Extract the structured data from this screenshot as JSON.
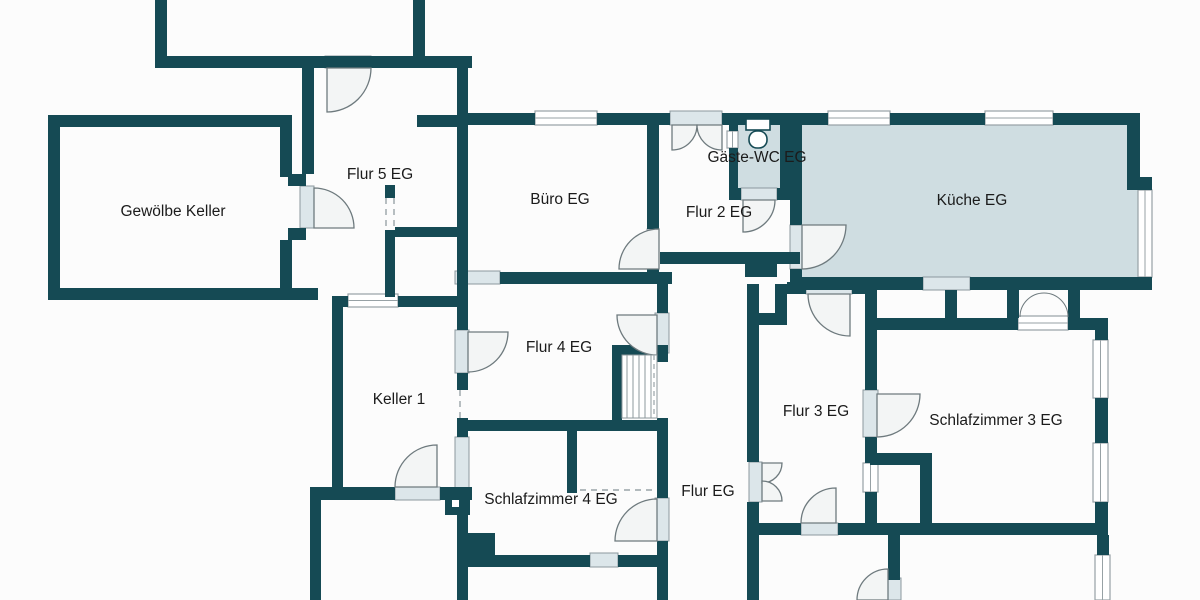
{
  "title": "Grundriss Erdgeschoss / Keller",
  "colors": {
    "background": "#fcfcfc",
    "wall": "#154a54",
    "room_fill": "#cfdde1",
    "door_sill": "#dce6ea",
    "sill_border": "#8b989e",
    "door_arc": "#6e7a7e",
    "door_leaf_fill": "#f3f5f5",
    "window_border": "#97a1a5",
    "stair_line": "#8e989c",
    "dash": "#9aa4a8",
    "text": "#1b1b1b"
  },
  "rooms": [
    {
      "key": "gewoelbe-keller",
      "label": "Gewölbe Keller",
      "x": 173,
      "y": 216
    },
    {
      "key": "flur-5-eg",
      "label": "Flur 5 EG",
      "x": 380,
      "y": 179
    },
    {
      "key": "buero-eg",
      "label": "Büro EG",
      "x": 560,
      "y": 204
    },
    {
      "key": "gaeste-wc-eg",
      "label": "Gäste-WC EG",
      "x": 757,
      "y": 162
    },
    {
      "key": "flur-2-eg",
      "label": "Flur 2 EG",
      "x": 719,
      "y": 217
    },
    {
      "key": "kueche-eg",
      "label": "Küche EG",
      "x": 972,
      "y": 205
    },
    {
      "key": "keller-1",
      "label": "Keller 1",
      "x": 399,
      "y": 404
    },
    {
      "key": "flur-4-eg",
      "label": "Flur 4 EG",
      "x": 559,
      "y": 352
    },
    {
      "key": "flur-3-eg",
      "label": "Flur 3 EG",
      "x": 816,
      "y": 416
    },
    {
      "key": "schlafzimmer-3-eg",
      "label": "Schlafzimmer 3 EG",
      "x": 996,
      "y": 425
    },
    {
      "key": "schlafzimmer-4-eg",
      "label": "Schlafzimmer 4 EG",
      "x": 551,
      "y": 504
    },
    {
      "key": "flur-eg",
      "label": "Flur EG",
      "x": 708,
      "y": 496
    }
  ],
  "geometry": {
    "fills": [
      {
        "x": 802,
        "y": 125,
        "w": 338,
        "h": 152
      },
      {
        "x": 737,
        "y": 118,
        "w": 43,
        "h": 70
      },
      {
        "x": 790,
        "y": 190,
        "w": 12,
        "h": 35
      }
    ],
    "walls": [
      [
        155,
        0,
        12,
        68
      ],
      [
        155,
        56,
        317,
        12
      ],
      [
        413,
        0,
        12,
        58
      ],
      [
        457,
        56,
        11,
        60
      ],
      [
        417,
        115,
        50,
        12
      ],
      [
        48,
        115,
        244,
        12
      ],
      [
        48,
        115,
        12,
        185
      ],
      [
        48,
        288,
        270,
        12
      ],
      [
        280,
        115,
        12,
        62
      ],
      [
        288,
        174,
        18,
        12
      ],
      [
        288,
        228,
        18,
        12
      ],
      [
        280,
        240,
        12,
        60
      ],
      [
        302,
        68,
        12,
        106
      ],
      [
        332,
        296,
        16,
        11
      ],
      [
        398,
        296,
        70,
        11
      ],
      [
        332,
        296,
        11,
        195
      ],
      [
        457,
        113,
        11,
        171
      ],
      [
        465,
        113,
        70,
        12
      ],
      [
        597,
        113,
        73,
        12
      ],
      [
        722,
        113,
        106,
        12
      ],
      [
        890,
        113,
        95,
        12
      ],
      [
        1053,
        113,
        85,
        12
      ],
      [
        647,
        113,
        12,
        116
      ],
      [
        647,
        269,
        12,
        15
      ],
      [
        500,
        272,
        172,
        12
      ],
      [
        385,
        185,
        10,
        13
      ],
      [
        385,
        230,
        10,
        67
      ],
      [
        395,
        227,
        65,
        10
      ],
      [
        729,
        118,
        9,
        13
      ],
      [
        729,
        148,
        9,
        40
      ],
      [
        780,
        118,
        10,
        72
      ],
      [
        777,
        188,
        15,
        12
      ],
      [
        729,
        188,
        12,
        12
      ],
      [
        790,
        113,
        12,
        112
      ],
      [
        790,
        269,
        12,
        21
      ],
      [
        1127,
        113,
        13,
        64
      ],
      [
        1127,
        177,
        25,
        13
      ],
      [
        790,
        277,
        133,
        13
      ],
      [
        970,
        277,
        182,
        13
      ],
      [
        660,
        252,
        85,
        12
      ],
      [
        745,
        252,
        32,
        25
      ],
      [
        777,
        252,
        23,
        12
      ],
      [
        657,
        284,
        11,
        29
      ],
      [
        657,
        353,
        11,
        9
      ],
      [
        657,
        418,
        11,
        80
      ],
      [
        657,
        541,
        11,
        59
      ],
      [
        612,
        345,
        56,
        10
      ],
      [
        612,
        352,
        10,
        75
      ],
      [
        457,
        420,
        211,
        11
      ],
      [
        457,
        284,
        11,
        46
      ],
      [
        457,
        373,
        11,
        17
      ],
      [
        457,
        418,
        11,
        19
      ],
      [
        457,
        490,
        11,
        110
      ],
      [
        310,
        487,
        85,
        13
      ],
      [
        440,
        487,
        32,
        13
      ],
      [
        310,
        500,
        11,
        100
      ],
      [
        445,
        495,
        25,
        20
      ],
      [
        468,
        537,
        22,
        10
      ],
      [
        468,
        555,
        22,
        10
      ],
      [
        567,
        420,
        10,
        73
      ],
      [
        457,
        555,
        133,
        12
      ],
      [
        618,
        555,
        50,
        12
      ],
      [
        465,
        533,
        30,
        22
      ],
      [
        747,
        284,
        12,
        178
      ],
      [
        747,
        502,
        12,
        98
      ],
      [
        747,
        313,
        35,
        12
      ],
      [
        775,
        284,
        12,
        41
      ],
      [
        787,
        282,
        19,
        12
      ],
      [
        852,
        282,
        25,
        12
      ],
      [
        865,
        284,
        12,
        106
      ],
      [
        865,
        437,
        12,
        26
      ],
      [
        865,
        492,
        12,
        31
      ],
      [
        747,
        523,
        54,
        12
      ],
      [
        838,
        523,
        270,
        12
      ],
      [
        870,
        453,
        62,
        12
      ],
      [
        920,
        465,
        12,
        58
      ],
      [
        888,
        535,
        12,
        45
      ],
      [
        1097,
        535,
        12,
        20
      ],
      [
        865,
        318,
        153,
        12
      ],
      [
        1068,
        318,
        32,
        12
      ],
      [
        945,
        290,
        12,
        28
      ],
      [
        1007,
        290,
        12,
        28
      ],
      [
        1068,
        290,
        12,
        28
      ],
      [
        1095,
        318,
        13,
        22
      ],
      [
        1095,
        398,
        13,
        45
      ],
      [
        1095,
        502,
        13,
        33
      ]
    ],
    "windows": [
      {
        "x": 535,
        "y": 111,
        "w": 62,
        "h": 14,
        "o": "h"
      },
      {
        "x": 828,
        "y": 111,
        "w": 62,
        "h": 14,
        "o": "h"
      },
      {
        "x": 985,
        "y": 111,
        "w": 68,
        "h": 14,
        "o": "h"
      },
      {
        "x": 348,
        "y": 294,
        "w": 50,
        "h": 13,
        "o": "h"
      },
      {
        "x": 1018,
        "y": 316,
        "w": 50,
        "h": 14,
        "o": "h"
      },
      {
        "x": 1138,
        "y": 190,
        "w": 14,
        "h": 87,
        "o": "v"
      },
      {
        "x": 1093,
        "y": 340,
        "w": 15,
        "h": 58,
        "o": "v"
      },
      {
        "x": 1093,
        "y": 443,
        "w": 15,
        "h": 59,
        "o": "v"
      },
      {
        "x": 863,
        "y": 463,
        "w": 15,
        "h": 29,
        "o": "v"
      },
      {
        "x": 1095,
        "y": 555,
        "w": 15,
        "h": 45,
        "o": "v"
      },
      {
        "x": 753,
        "y": 255,
        "w": 14,
        "h": 15,
        "o": "v"
      },
      {
        "x": 727,
        "y": 131,
        "w": 11,
        "h": 17,
        "o": "v"
      }
    ],
    "sills": [
      [
        325,
        56,
        46,
        12
      ],
      [
        300,
        186,
        14,
        42
      ],
      [
        647,
        229,
        12,
        40
      ],
      [
        741,
        188,
        36,
        12
      ],
      [
        790,
        225,
        12,
        44
      ],
      [
        455,
        330,
        14,
        43
      ],
      [
        395,
        487,
        45,
        13
      ],
      [
        655,
        313,
        14,
        40
      ],
      [
        806,
        282,
        46,
        12
      ],
      [
        863,
        390,
        15,
        47
      ],
      [
        801,
        523,
        37,
        12
      ],
      [
        655,
        498,
        14,
        43
      ],
      [
        749,
        462,
        13,
        40
      ],
      [
        886,
        578,
        15,
        22
      ],
      [
        923,
        277,
        47,
        13
      ],
      [
        670,
        111,
        52,
        14
      ],
      [
        455,
        271,
        45,
        13
      ],
      [
        455,
        437,
        14,
        53
      ],
      [
        590,
        553,
        28,
        14
      ]
    ],
    "doors": [
      "M327,68 L327,112 A44,44 0 0 0 371,68 Z",
      "M314,228 L314,188 A40,40 0 0 1 354,228 Z",
      "M659,269 L659,229 A40,40 0 0 0 619,269 Z",
      "M672,125 L672,150 A25,25 0 0 0 697,125 Z",
      "M722,125 L722,150 A25,25 0 0 1 697,125 Z",
      "M743,200 L743,232 A32,32 0 0 0 775,200 Z",
      "M802,225 L846,225 A44,44 0 0 1 802,269 Z",
      "M468,332 L468,372 A40,40 0 0 0 508,332 Z",
      "M437,487 L395,487 A42,42 0 0 1 437,445 Z",
      "M657,315 L617,315 A40,40 0 0 0 657,355 Z",
      "M850,294 L808,294 A42,42 0 0 0 850,336 Z",
      "M877,394 L920,394 A43,43 0 0 1 877,437 Z",
      "M836,523 L836,488 A35,35 0 0 0 801,523 Z",
      "M657,541 L657,499 A42,42 0 0 0 615,541 Z",
      "M888,600 L888,569 A31,31 0 0 0 857,600 Z",
      "M762,463 L762,483 A20,20 0 0 0 782,463 Z",
      "M762,501 L762,481 A20,20 0 0 1 782,501 Z"
    ],
    "curves": [
      "M1020,317 A24,24 0 0 1 1044,293",
      "M1068,317 A24,24 0 0 0 1044,293"
    ],
    "dashes": [
      [
        580,
        490,
        655,
        490
      ],
      [
        386,
        198,
        386,
        230
      ],
      [
        394,
        198,
        394,
        230
      ],
      [
        460,
        390,
        460,
        418
      ],
      [
        622,
        358,
        657,
        358
      ]
    ],
    "stairs": {
      "x": 622,
      "y": 355,
      "w": 35,
      "h": 63,
      "treads": [
        627,
        633,
        639,
        645,
        651
      ],
      "dash_x": 654
    },
    "toilet": {
      "tank": [
        746,
        119,
        24,
        11
      ],
      "bowl": [
        749,
        131,
        18,
        17
      ]
    },
    "white_dots": [
      [
        452,
        500,
        7,
        7
      ]
    ]
  }
}
